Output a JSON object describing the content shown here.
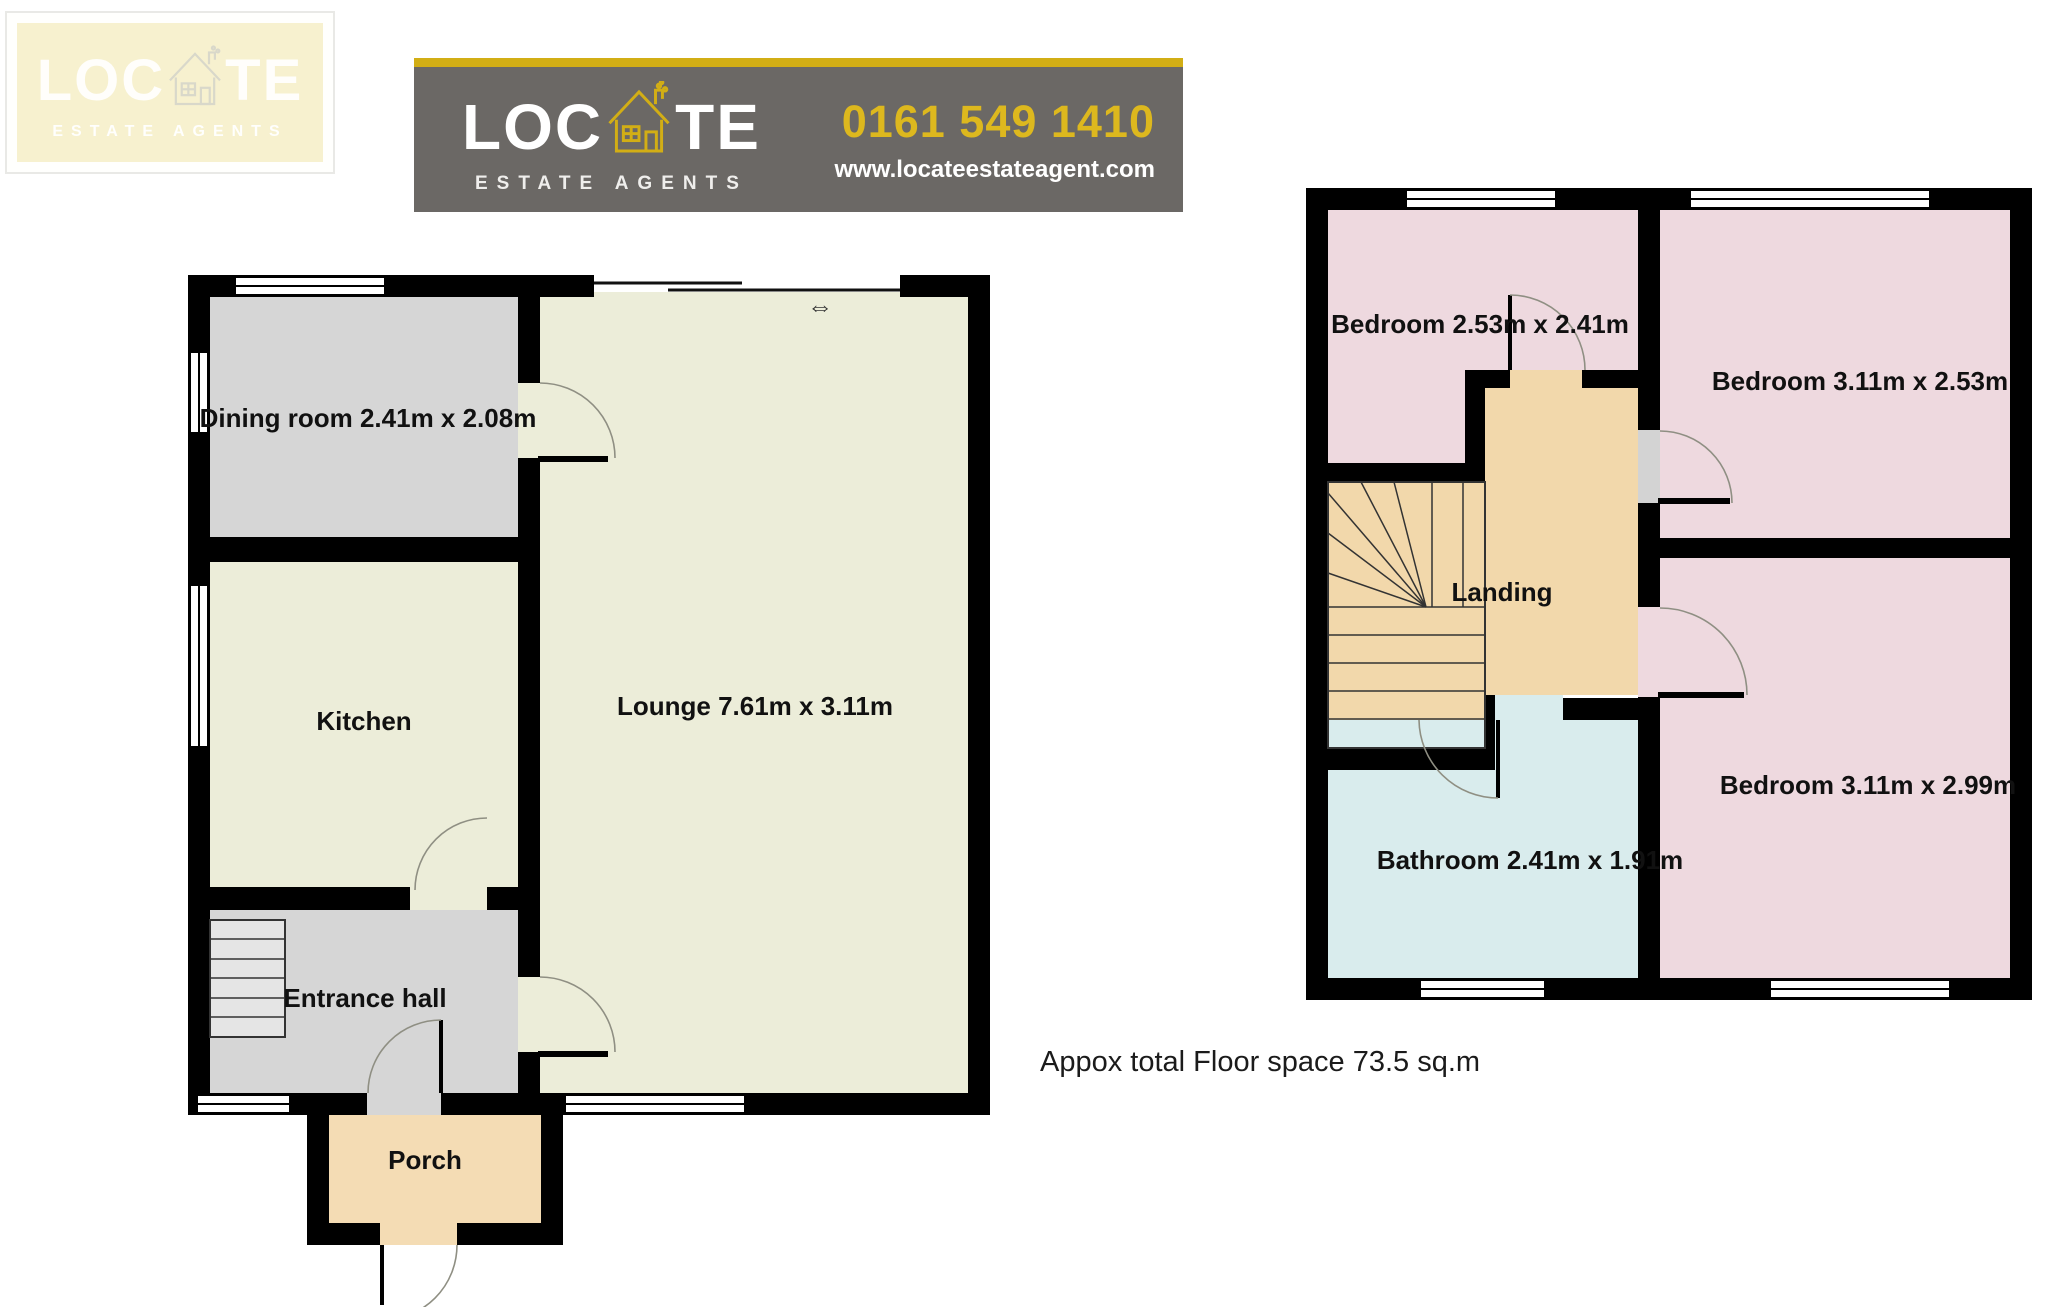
{
  "watermark": {
    "word_left": "LOC",
    "word_right": "TE",
    "tagline": "ESTATE AGENTS"
  },
  "banner": {
    "word_left": "LOC",
    "word_right": "TE",
    "tagline": "ESTATE AGENTS",
    "phone": "0161 549 1410",
    "website": "www.locateestateagent.com"
  },
  "colors": {
    "banner_yellow": "#d2ae15",
    "banner_gray": "#6b6865",
    "wall_black": "#000000",
    "room_gray": "#d6d6d6",
    "room_cream": "#ecedd9",
    "room_tan": "#f2d8ab",
    "room_porch_tan": "#f4dcb4",
    "room_pink": "#eed9df",
    "room_blue": "#d9eced",
    "stairs_gray": "#e5e5e5",
    "door_panel_gray": "#d3d3d3"
  },
  "ground_floor": {
    "rooms": [
      {
        "id": "dining-room",
        "label": "Dining room 2.41m x 2.08m"
      },
      {
        "id": "kitchen",
        "label": "Kitchen"
      },
      {
        "id": "lounge",
        "label": "Lounge 7.61m x 3.11m"
      },
      {
        "id": "entrance-hall",
        "label": "Entrance hall"
      },
      {
        "id": "porch",
        "label": "Porch"
      }
    ]
  },
  "first_floor": {
    "rooms": [
      {
        "id": "bedroom-1",
        "label": "Bedroom 2.53m x 2.41m"
      },
      {
        "id": "bedroom-2",
        "label": "Bedroom 3.11m x 2.53m"
      },
      {
        "id": "bedroom-3",
        "label": "Bedroom 3.11m x 2.99m"
      },
      {
        "id": "landing",
        "label": "Landing"
      },
      {
        "id": "bathroom",
        "label": "Bathroom 2.41m x 1.91m"
      }
    ]
  },
  "footer": {
    "note": "Appox total Floor space 73.5 sq.m"
  },
  "symbols": {
    "sliding_door_arrow": "⇔"
  }
}
